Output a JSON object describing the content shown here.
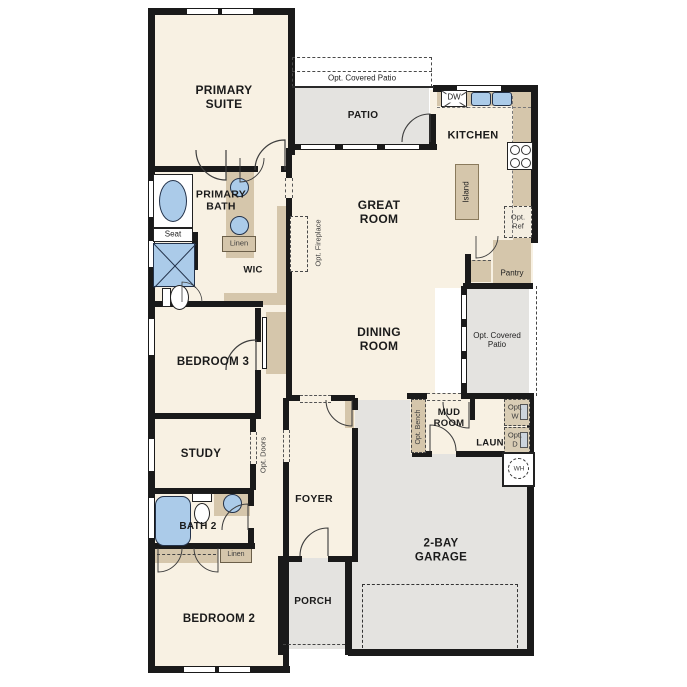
{
  "colors": {
    "wall": "#1a1a1a",
    "interior": "#f8f1e3",
    "outdoor": "#e4e3e0",
    "cabinet": "#d5c6ab",
    "fixture_blue": "#abcbe9",
    "text": "#1b1b1b"
  },
  "rooms": {
    "primary_suite": "PRIMARY SUITE",
    "primary_bath": "PRIMARY BATH",
    "wic": "WIC",
    "patio": "PATIO",
    "kitchen": "KITCHEN",
    "great_room": "GREAT ROOM",
    "dining_room": "DINING ROOM",
    "bedroom_3": "BEDROOM 3",
    "study": "STUDY",
    "bath_2": "BATH 2",
    "bedroom_2": "BEDROOM 2",
    "foyer": "FOYER",
    "porch": "PORCH",
    "garage": "2-BAY GARAGE",
    "mud_room": "MUD ROOM",
    "laundry": "LAUN"
  },
  "options": {
    "covered_patio_top": "Opt. Covered Patio",
    "covered_patio_right": "Opt. Covered Patio",
    "fireplace": "Opt. Fireplace",
    "doors": "Opt. Doors",
    "bench": "Opt. Bench",
    "ref": "Opt. Ref",
    "washer": "Opt. W",
    "dryer": "Opt. D"
  },
  "fixtures": {
    "seat": "Seat",
    "linen_primary": "Linen",
    "linen_hall": "Linen",
    "dishwasher": "DW",
    "island": "Island",
    "pantry": "Pantry",
    "water_heater": "WH"
  }
}
